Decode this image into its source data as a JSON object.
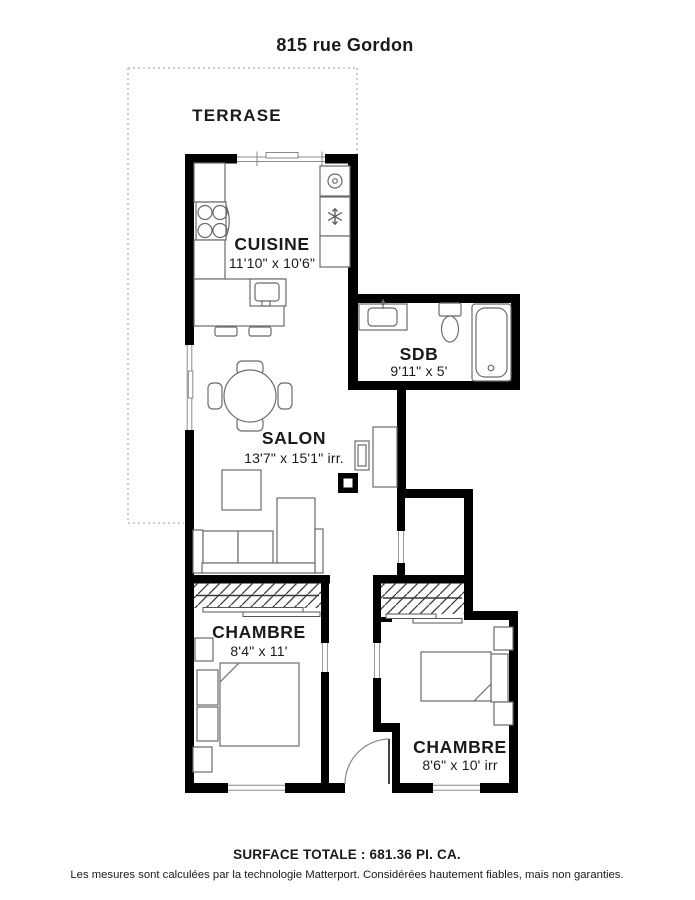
{
  "title": "815 rue Gordon",
  "plan": {
    "terrace": {
      "label": "TERRASE"
    },
    "rooms": [
      {
        "name": "cuisine",
        "label": "CUISINE",
        "dims": "11'10\" x 10'6\""
      },
      {
        "name": "sdb",
        "label": "SDB",
        "dims": "9'11\" x 5'"
      },
      {
        "name": "salon",
        "label": "SALON",
        "dims": "13'7\" x 15'1\" irr."
      },
      {
        "name": "chambre-1",
        "label": "CHAMBRE",
        "dims": "8'4\" x 11'"
      },
      {
        "name": "chambre-2",
        "label": "CHAMBRE",
        "dims": "8'6\" x 10' irr"
      }
    ],
    "icons": {
      "washer": "washing-machine",
      "freezer": "snowflake",
      "stove": "four-burner-stove"
    }
  },
  "footer": {
    "surface_total": "SURFACE TOTALE : 681.36 PI. CA.",
    "disclaimer": "Les mesures sont calculées par la technologie Matterport. Considérées hautement fiables, mais non garanties."
  },
  "colors": {
    "walls": "#000000",
    "background": "#ffffff",
    "furniture_line": "#6b6b6b",
    "text": "#1a1a1a"
  }
}
